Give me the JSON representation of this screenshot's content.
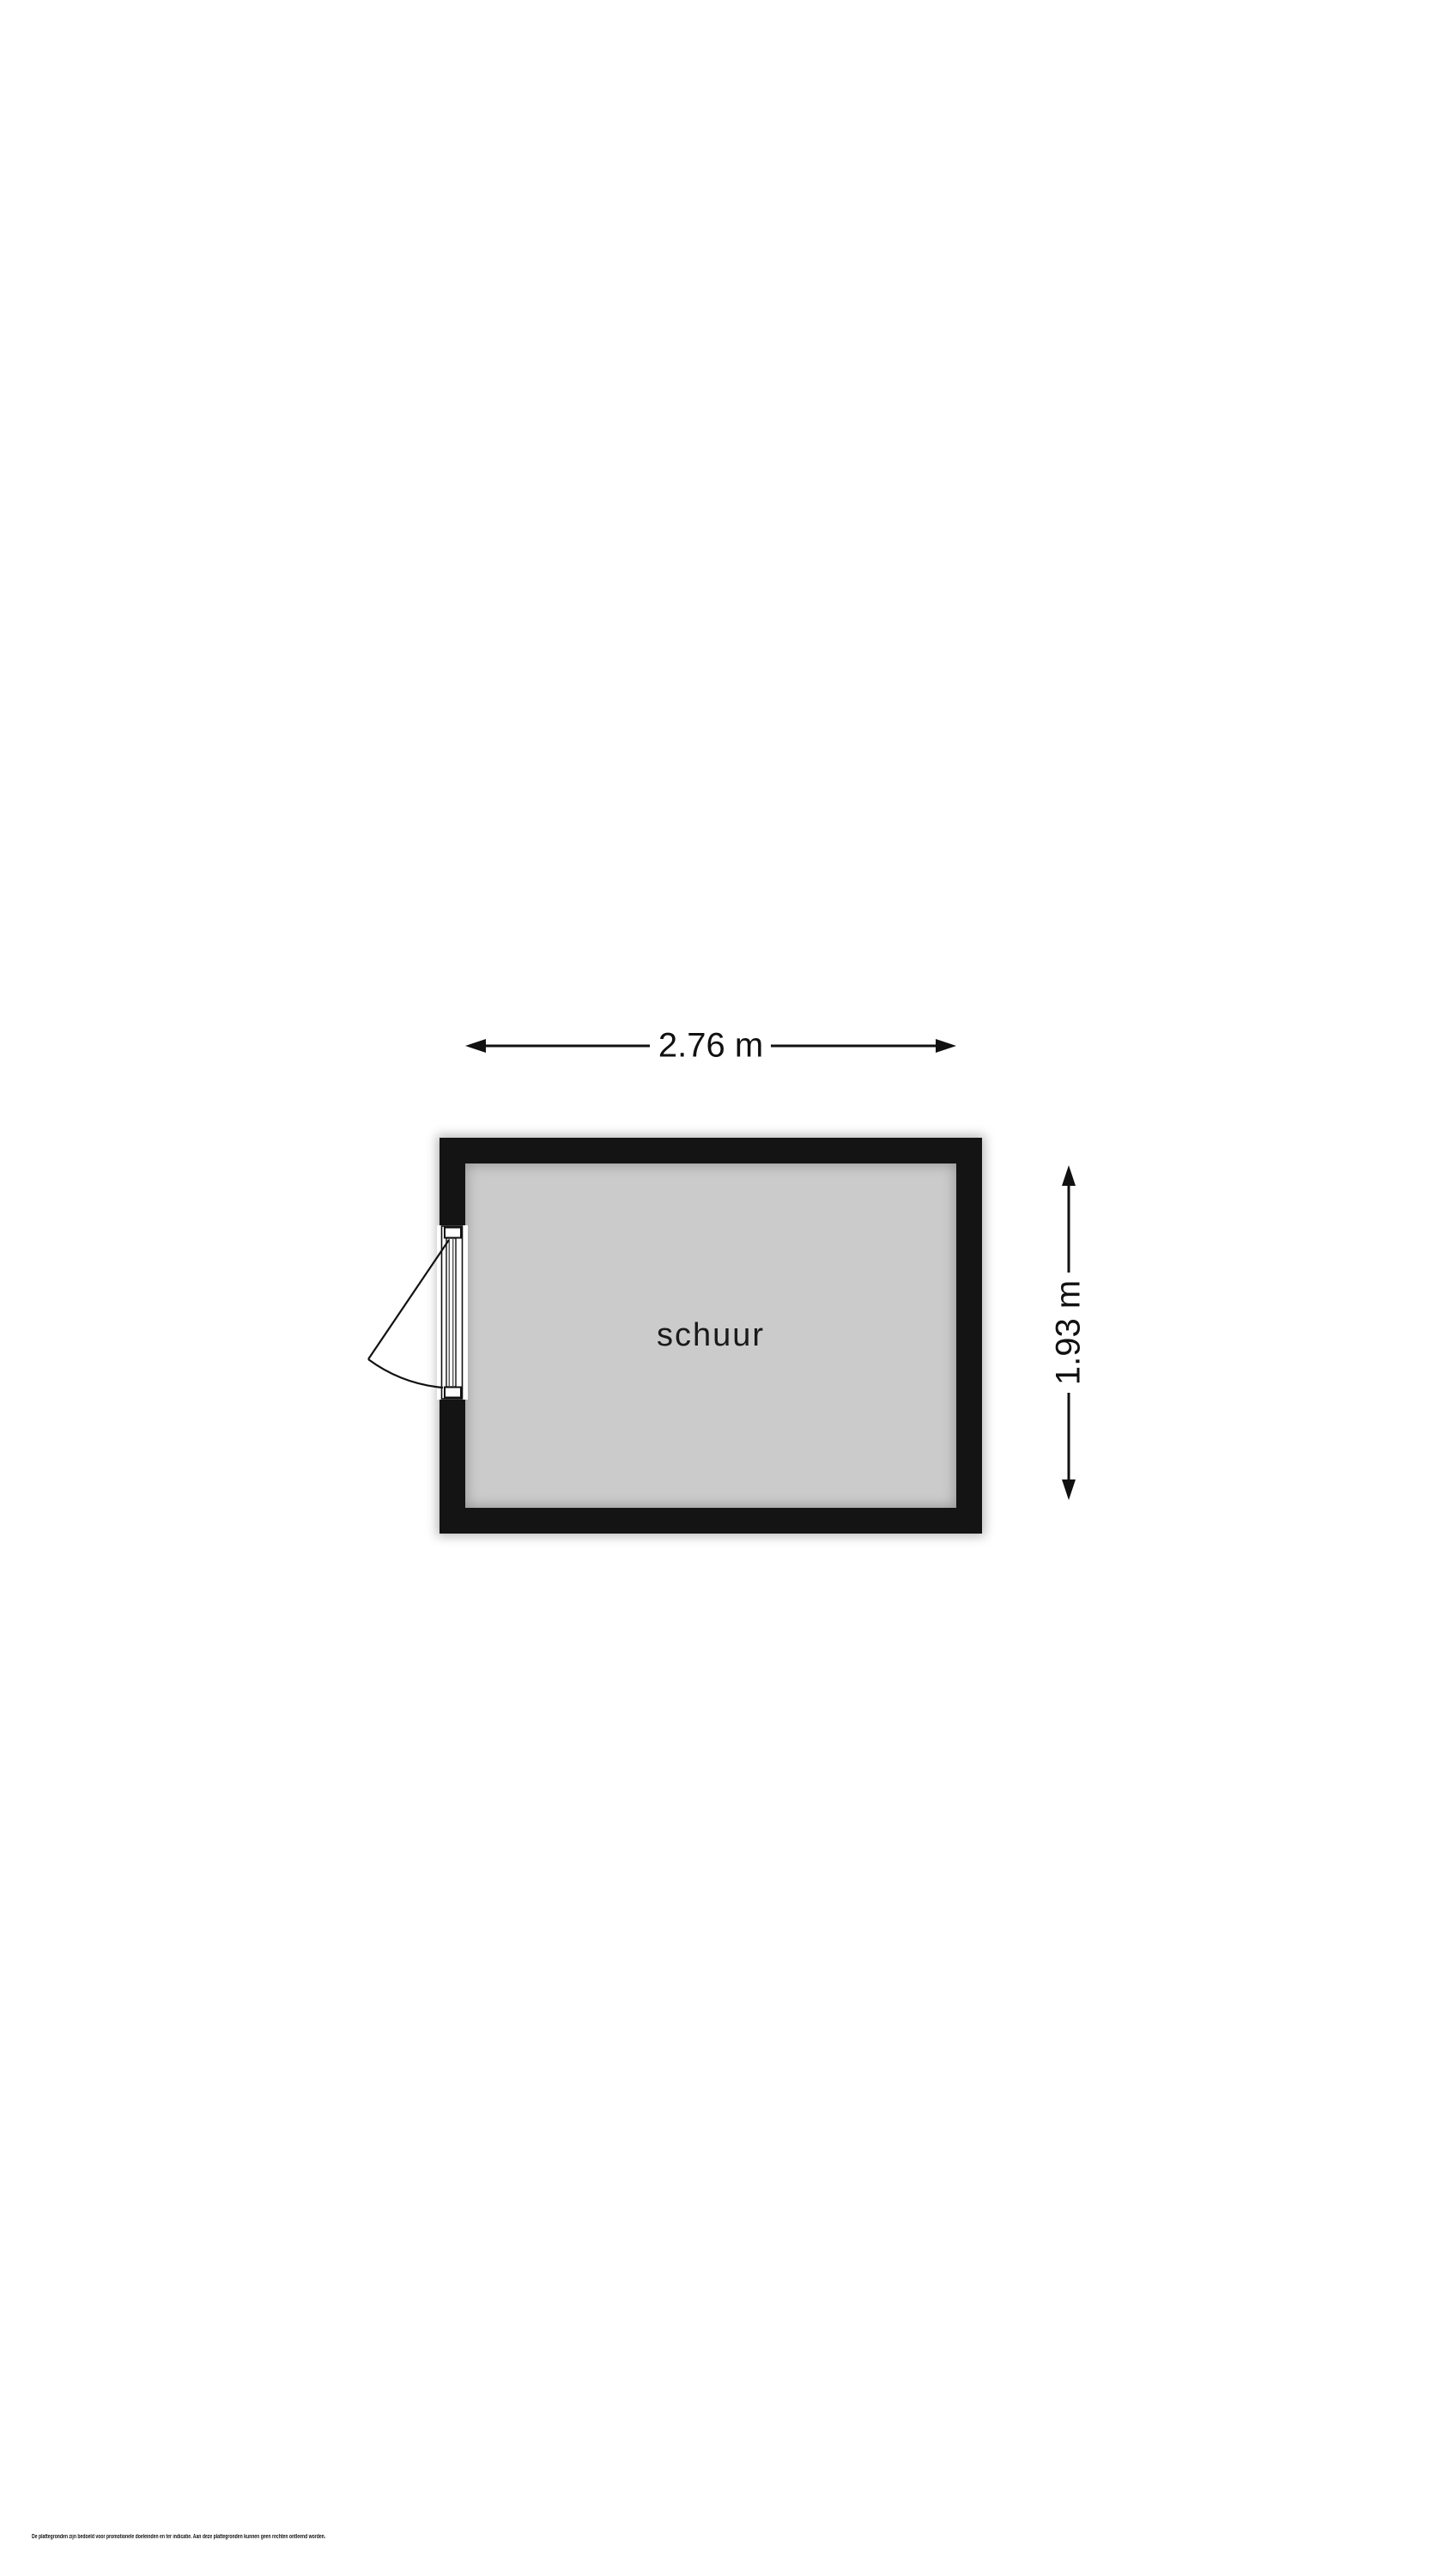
{
  "page": {
    "background_color": "#ffffff",
    "disclaimer": "De plattegronden zijn bedoeld voor promotionele doeleinden en ter indicatie. Aan deze plattegronden kunnen geen rechten ontleend worden."
  },
  "floorplan": {
    "room_label": "schuur",
    "width_dimension": "2.76 m",
    "height_dimension": "1.93 m",
    "colors": {
      "wall": "#141414",
      "floor": "#cbcbcb",
      "line": "#111111"
    },
    "icons": {
      "width_arrow": "double-headed-horizontal-arrow",
      "height_arrow": "double-headed-vertical-arrow",
      "door": "door-leaf-with-swing-arc"
    }
  }
}
